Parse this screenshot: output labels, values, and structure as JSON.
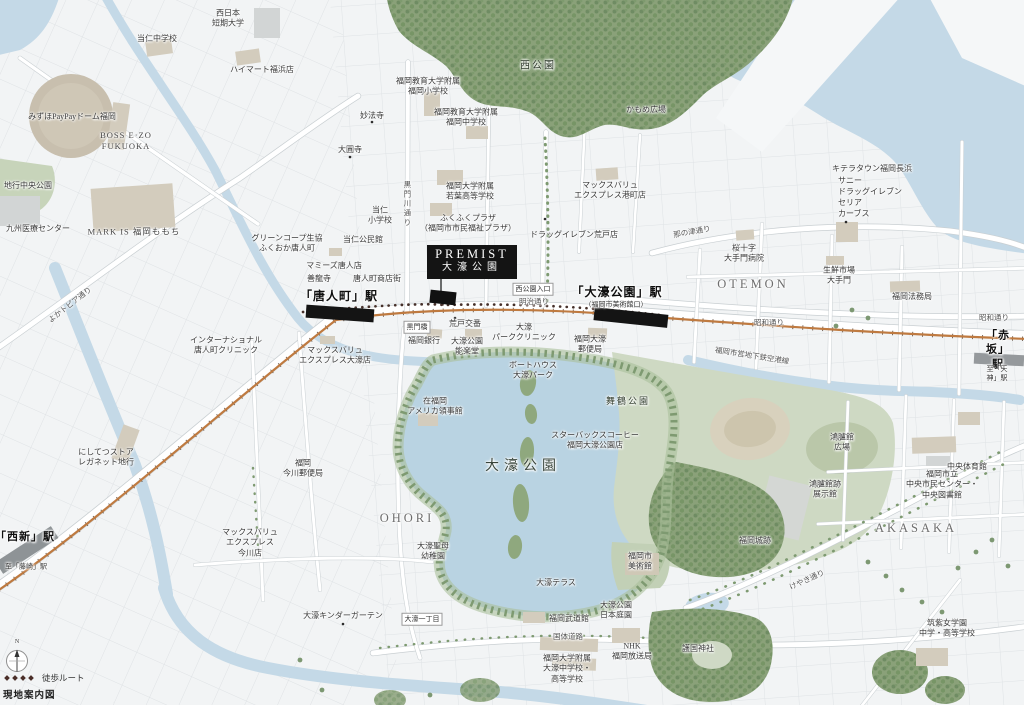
{
  "map": {
    "callout": {
      "line1": "PREMIST",
      "line2": "大濠公園"
    },
    "legend": {
      "walk_route": "徒歩ルート",
      "caption": "現地案内図",
      "compass_n": "N"
    },
    "colors": {
      "land": "#f2f4f5",
      "water": "#c4d9e7",
      "lake": "#b9d3e2",
      "forest": "#8aa179",
      "park": "#ced9c3",
      "field": "#d8d1bd",
      "building": "#d3ccbd",
      "rail_line": "#bf7a40",
      "station_bar": "#141414",
      "walk_route_dot": "#46302a",
      "callout_bg": "#141414",
      "label_text": "#3a3a3a"
    },
    "labels": [
      {
        "t": "当仁中学校",
        "x": 157,
        "y": 39
      },
      {
        "t": "西日本\n短期大学",
        "x": 228,
        "y": 19
      },
      {
        "t": "ハイマート福浜店",
        "x": 262,
        "y": 70
      },
      {
        "t": "みずほPayPayドーム福岡",
        "x": 72,
        "y": 117
      },
      {
        "t": "BOSS E·ZO\nFUKUOKA",
        "x": 126,
        "y": 141,
        "k": "latin"
      },
      {
        "t": "地行中央公園",
        "x": 28,
        "y": 186
      },
      {
        "t": "九州医療センター",
        "x": 38,
        "y": 229
      },
      {
        "t": "MARK IS 福岡ももち",
        "x": 134,
        "y": 232,
        "k": "latin"
      },
      {
        "t": "妙法寺",
        "x": 372,
        "y": 116
      },
      {
        "t": "大圓寺",
        "x": 350,
        "y": 150
      },
      {
        "t": "福岡教育大学附属\n福岡小学校",
        "x": 428,
        "y": 87
      },
      {
        "t": "福岡教育大学附属\n福岡中学校",
        "x": 466,
        "y": 118
      },
      {
        "t": "西公園",
        "x": 538,
        "y": 66,
        "k": "park"
      },
      {
        "t": "かもめ広場",
        "x": 646,
        "y": 110
      },
      {
        "t": "キテラタウン福岡長浜",
        "x": 872,
        "y": 169
      },
      {
        "t": "サニー",
        "x": 838,
        "y": 181,
        "a": 1
      },
      {
        "t": "ドラッグイレブン",
        "x": 838,
        "y": 192,
        "a": 1
      },
      {
        "t": "セリア",
        "x": 838,
        "y": 203,
        "a": 1
      },
      {
        "t": "カーブス",
        "x": 838,
        "y": 214,
        "a": 1
      },
      {
        "t": "那の津通り",
        "x": 692,
        "y": 232,
        "k": "road",
        "r": -10
      },
      {
        "t": "桜十字\n大手門病院",
        "x": 744,
        "y": 254
      },
      {
        "t": "OTEMON",
        "x": 753,
        "y": 284,
        "k": "district"
      },
      {
        "t": "生鮮市場\n大手門",
        "x": 839,
        "y": 276
      },
      {
        "t": "福岡法務局",
        "x": 912,
        "y": 297
      },
      {
        "t": "昭和通り",
        "x": 769,
        "y": 323,
        "k": "road"
      },
      {
        "t": "昭和通り",
        "x": 994,
        "y": 318,
        "k": "road"
      },
      {
        "t": "マックスバリュ\nエクスプレス港町店",
        "x": 610,
        "y": 191
      },
      {
        "t": "ドラッグイレブン荒戸店",
        "x": 574,
        "y": 235
      },
      {
        "t": "ふくふくプラザ\n（福岡市市民福祉プラザ）",
        "x": 468,
        "y": 224
      },
      {
        "t": "福岡大学附属\n若葉高等学校",
        "x": 470,
        "y": 192
      },
      {
        "t": "当仁\n小学校",
        "x": 380,
        "y": 216
      },
      {
        "t": "黒門川通り",
        "x": 407,
        "y": 204,
        "k": "road",
        "v": 1
      },
      {
        "t": "グリーンコープ生協\nふくおか唐人町",
        "x": 287,
        "y": 244
      },
      {
        "t": "当仁公民館",
        "x": 363,
        "y": 240
      },
      {
        "t": "マミーズ唐人店",
        "x": 334,
        "y": 266
      },
      {
        "t": "善龍寺",
        "x": 319,
        "y": 279
      },
      {
        "t": "唐人町商店街",
        "x": 377,
        "y": 279
      },
      {
        "t": "「唐人町」駅",
        "x": 339,
        "y": 297,
        "k": "station"
      },
      {
        "t": "福岡銀行",
        "x": 424,
        "y": 341
      },
      {
        "t": "黒門橋",
        "x": 417,
        "y": 327,
        "k": "boxed"
      },
      {
        "t": "インターナショナル\n唐人町クリニック",
        "x": 226,
        "y": 346
      },
      {
        "t": "マックスバリュ\nエクスプレス大濠店",
        "x": 335,
        "y": 356
      },
      {
        "t": "よかトピア通り",
        "x": 70,
        "y": 305,
        "k": "road",
        "r": -38
      },
      {
        "t": "にしてつストア\nレガネット地行",
        "x": 106,
        "y": 458
      },
      {
        "t": "「西新」駅",
        "x": 25,
        "y": 537,
        "k": "station",
        "fs": 11
      },
      {
        "t": "至「藤崎」駅",
        "x": 26,
        "y": 567,
        "k": "sub"
      },
      {
        "t": "西公園入口",
        "x": 533,
        "y": 289,
        "k": "boxed"
      },
      {
        "t": "明治通り",
        "x": 534,
        "y": 302,
        "k": "road"
      },
      {
        "t": "「大濠公園」駅",
        "x": 617,
        "y": 293,
        "k": "station"
      },
      {
        "t": "（福岡市美術館口）",
        "x": 616,
        "y": 305,
        "k": "sub"
      },
      {
        "t": "荒戸交番",
        "x": 465,
        "y": 324
      },
      {
        "t": "大濠\nパーククリニック",
        "x": 524,
        "y": 333
      },
      {
        "t": "福岡大濠\n郵便局",
        "x": 590,
        "y": 345
      },
      {
        "t": "大濠公園\n能楽堂",
        "x": 467,
        "y": 347
      },
      {
        "t": "福岡市営地下鉄空港線",
        "x": 752,
        "y": 356,
        "k": "road",
        "r": 9
      },
      {
        "t": "ボートハウス\n大濠パーク",
        "x": 533,
        "y": 371
      },
      {
        "t": "在福岡\nアメリカ領事館",
        "x": 435,
        "y": 407
      },
      {
        "t": "舞鶴公園",
        "x": 628,
        "y": 402,
        "k": "park",
        "fs": 9
      },
      {
        "t": "スターバックスコーヒー\n福岡大濠公園店",
        "x": 595,
        "y": 441
      },
      {
        "t": "大濠公園",
        "x": 523,
        "y": 467,
        "k": "big"
      },
      {
        "t": "OHORI",
        "x": 407,
        "y": 518,
        "k": "district"
      },
      {
        "t": "AKASAKA",
        "x": 916,
        "y": 528,
        "k": "district"
      },
      {
        "t": "鴻臚館\n広場",
        "x": 842,
        "y": 443
      },
      {
        "t": "鴻臚館跡\n展示館",
        "x": 825,
        "y": 490
      },
      {
        "t": "福岡城跡",
        "x": 755,
        "y": 541
      },
      {
        "t": "中央体育館",
        "x": 967,
        "y": 467
      },
      {
        "t": "福岡市立\n中央市民センター・\n中央図書館",
        "x": 942,
        "y": 485
      },
      {
        "t": "けやき通り",
        "x": 807,
        "y": 580,
        "k": "road",
        "r": -24
      },
      {
        "t": "「赤坂」駅",
        "x": 998,
        "y": 350,
        "k": "station",
        "fs": 11
      },
      {
        "t": "至「天神」駅",
        "x": 997,
        "y": 374,
        "k": "sub"
      },
      {
        "t": "護国神社",
        "x": 698,
        "y": 649
      },
      {
        "t": "筑紫女学園\n中学・高等学校",
        "x": 947,
        "y": 629
      },
      {
        "t": "福岡市\n美術館",
        "x": 640,
        "y": 562
      },
      {
        "t": "大濠テラス",
        "x": 556,
        "y": 583
      },
      {
        "t": "大濠公園\n日本庭園",
        "x": 616,
        "y": 611
      },
      {
        "t": "福岡武道館",
        "x": 569,
        "y": 619
      },
      {
        "t": "国体道路",
        "x": 568,
        "y": 637,
        "k": "road"
      },
      {
        "t": "福岡大学附属\n大濠中学校・\n高等学校",
        "x": 567,
        "y": 669
      },
      {
        "t": "NHK\n福岡放送局",
        "x": 632,
        "y": 652
      },
      {
        "t": "大濠一丁目",
        "x": 422,
        "y": 619,
        "k": "boxed"
      },
      {
        "t": "大濠聖母\n幼稚園",
        "x": 433,
        "y": 552
      },
      {
        "t": "大濠キンダーガーテン",
        "x": 343,
        "y": 616
      },
      {
        "t": "福岡\n今川郵便局",
        "x": 303,
        "y": 469
      },
      {
        "t": "マックスバリュ\nエクスプレス\n今川店",
        "x": 250,
        "y": 543
      },
      {
        "t": "N",
        "x": 17,
        "y": 643,
        "k": "sub",
        "fs": 6
      }
    ]
  }
}
